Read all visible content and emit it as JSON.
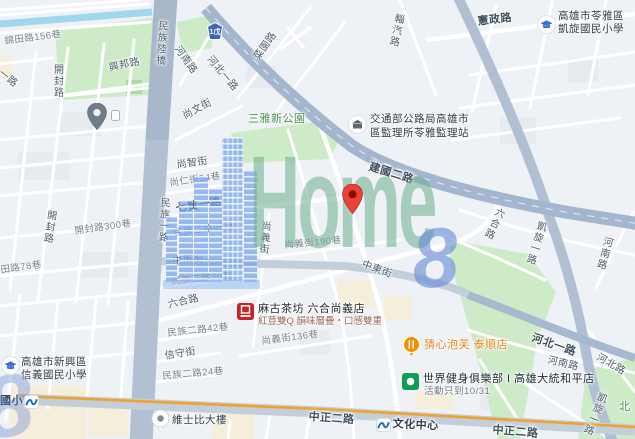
{
  "map": {
    "watermark": {
      "word": "Home",
      "digit": "8"
    },
    "colors": {
      "land": "#eef1f5",
      "park": "#cdebc7",
      "water": "#9fd8ec",
      "major_road": "#a3b6ce",
      "arterial_stripe": "#f0a32c",
      "watermark_green": "#71b193",
      "watermark_blue": "#658bd5",
      "destination_pin": "#ea4335"
    },
    "highway_shield": {
      "label": "1戊",
      "x": 207,
      "y": 22
    },
    "labels": [
      {
        "n": "road-label-jintian-156",
        "t": "錦田路156巷",
        "x": 4,
        "y": 37,
        "r": -7,
        "c": "lane"
      },
      {
        "n": "road-label-xingbang",
        "t": "興邦路",
        "x": 108,
        "y": 63,
        "r": -12,
        "c": "road"
      },
      {
        "n": "road-label-kaifeng-n",
        "t": "開封路",
        "x": 51,
        "y": 64,
        "r": 0,
        "c": "road",
        "v": true
      },
      {
        "n": "road-label-yilu",
        "t": "一路",
        "x": 3,
        "y": 68,
        "r": 38,
        "c": "road"
      },
      {
        "n": "road-label-minzu-viaduct",
        "t": "民族陸橋",
        "x": 156,
        "y": 20,
        "r": 4,
        "c": "road",
        "v": true
      },
      {
        "n": "road-label-henan-n",
        "t": "河南路",
        "x": 181,
        "y": 44,
        "r": 55,
        "c": "road"
      },
      {
        "n": "road-label-shangwen",
        "t": "尚文街",
        "x": 181,
        "y": 112,
        "r": -28,
        "c": "road"
      },
      {
        "n": "road-label-shangzhi",
        "t": "尚智街",
        "x": 176,
        "y": 160,
        "r": -8,
        "c": "road"
      },
      {
        "n": "road-label-shangren-54",
        "t": "尚仁街54巷",
        "x": 169,
        "y": 179,
        "r": -8,
        "c": "lane"
      },
      {
        "n": "road-label-qixian-1",
        "t": "七賢一路",
        "x": 175,
        "y": 203,
        "r": -9,
        "c": "roadb"
      },
      {
        "n": "road-label-minzu-1",
        "t": "民族一路",
        "x": 158,
        "y": 197,
        "r": 3,
        "c": "road",
        "v": true
      },
      {
        "n": "road-label-minzu2-95",
        "t": "民族二路95巷",
        "x": 173,
        "y": 229,
        "r": -7,
        "c": "lane"
      },
      {
        "n": "road-label-zhongdong-w",
        "t": "中東街",
        "x": 172,
        "y": 256,
        "r": -4,
        "c": "road"
      },
      {
        "n": "road-label-kaifeng-300",
        "t": "開封路300巷",
        "x": 74,
        "y": 227,
        "r": -8,
        "c": "lane"
      },
      {
        "n": "road-label-tian-78",
        "t": "田路78巷",
        "x": 0,
        "y": 266,
        "r": -8,
        "c": "lane"
      },
      {
        "n": "road-label-kaifeng-s",
        "t": "開封路",
        "x": 45,
        "y": 209,
        "r": 8,
        "c": "road",
        "v": true
      },
      {
        "n": "road-label-minzu2-70",
        "t": "民族二路70巷",
        "x": 171,
        "y": 277,
        "r": -5,
        "c": "lane"
      },
      {
        "n": "road-label-shangyi",
        "t": "尚義街",
        "x": 259,
        "y": 220,
        "r": 5,
        "c": "road",
        "v": true
      },
      {
        "n": "road-label-shangyi-190",
        "t": "尚義街190巷",
        "x": 284,
        "y": 241,
        "r": -5,
        "c": "lane"
      },
      {
        "n": "road-label-zhongdong-e",
        "t": "中東街",
        "x": 364,
        "y": 259,
        "r": 20,
        "c": "road"
      },
      {
        "n": "park-label-sanya",
        "t": "三雅新公園",
        "x": 248,
        "y": 113,
        "r": 0,
        "c": "park"
      },
      {
        "n": "road-label-hebei1-n",
        "t": "河北一路",
        "x": 213,
        "y": 54,
        "r": 50,
        "c": "road"
      },
      {
        "n": "road-label-caiyuan",
        "t": "菜園路",
        "x": 252,
        "y": 56,
        "r": -55,
        "c": "road"
      },
      {
        "n": "road-label-ziqi",
        "t": "輜汽路",
        "x": 393,
        "y": 12,
        "r": 12,
        "c": "road",
        "v": true
      },
      {
        "n": "road-label-xianzheng",
        "t": "憲政路",
        "x": 477,
        "y": 16,
        "r": -7,
        "c": "roadb"
      },
      {
        "n": "road-label-jianguo-2",
        "t": "建國二路",
        "x": 371,
        "y": 161,
        "r": 17,
        "c": "roadb"
      },
      {
        "n": "road-label-liuhe-n",
        "t": "六合路",
        "x": 495,
        "y": 205,
        "r": 25,
        "c": "road",
        "v": true
      },
      {
        "n": "road-label-kaixuan-mid",
        "t": "凱旋一路",
        "x": 536,
        "y": 219,
        "r": 17,
        "c": "road",
        "v": true
      },
      {
        "n": "road-label-henan-e",
        "t": "河南路",
        "x": 602,
        "y": 235,
        "r": 15,
        "c": "road",
        "v": true
      },
      {
        "n": "road-label-hebei1-s",
        "t": "河北一路",
        "x": 534,
        "y": 332,
        "r": 19,
        "c": "roadb"
      },
      {
        "n": "road-label-henan-s",
        "t": "河南路",
        "x": 549,
        "y": 355,
        "r": 13,
        "c": "road"
      },
      {
        "n": "road-label-hebei",
        "t": "河北路",
        "x": 600,
        "y": 352,
        "r": 30,
        "c": "road"
      },
      {
        "n": "road-label-liuhe-s",
        "t": "六合路",
        "x": 167,
        "y": 300,
        "r": -13,
        "c": "road"
      },
      {
        "n": "road-label-minzu2-42",
        "t": "民族二路42巷",
        "x": 167,
        "y": 329,
        "r": -6,
        "c": "lane"
      },
      {
        "n": "road-label-xinshou",
        "t": "信守街",
        "x": 164,
        "y": 351,
        "r": -9,
        "c": "road"
      },
      {
        "n": "road-label-minzu2-24",
        "t": "民族二路24巷",
        "x": 162,
        "y": 372,
        "r": -5,
        "c": "lane"
      },
      {
        "n": "road-label-shangyi-136",
        "t": "尚義街136巷",
        "x": 261,
        "y": 337,
        "r": -7,
        "c": "lane"
      },
      {
        "n": "road-label-zhongzheng-w",
        "t": "中正二路",
        "x": 309,
        "y": 411,
        "r": 4,
        "c": "roadb"
      },
      {
        "n": "road-label-zhongzheng-e",
        "t": "中正二路",
        "x": 493,
        "y": 424,
        "r": 5,
        "c": "roadb"
      },
      {
        "n": "road-label-kaixuan-s",
        "t": "凱旋一路",
        "x": 597,
        "y": 390,
        "r": 22,
        "c": "road",
        "v": true
      },
      {
        "n": "park-label-north",
        "t": "北",
        "x": 619,
        "y": 401,
        "r": 0,
        "c": "park"
      },
      {
        "n": "station-label-guoxiao",
        "t": "國小",
        "x": 0,
        "y": 395,
        "r": 0,
        "c": "station"
      },
      {
        "n": "station-label-cultural-center",
        "t": "文化中心",
        "x": 393,
        "y": 418,
        "r": 3,
        "c": "station"
      },
      {
        "n": "poi-label-weishibi",
        "t": "維士比大樓",
        "x": 172,
        "y": 414,
        "r": 0,
        "c": "poi"
      },
      {
        "n": "poi-label-kaixuan-school-1",
        "t": "高雄市苓雅區",
        "x": 558,
        "y": 10,
        "r": 0,
        "c": "poi"
      },
      {
        "n": "poi-label-kaixuan-school-2",
        "t": "凱旋國民小學",
        "x": 558,
        "y": 23,
        "r": 0,
        "c": "poi"
      },
      {
        "n": "poi-label-dmv-1",
        "t": "交通部公路局高雄市",
        "x": 370,
        "y": 113,
        "r": 0,
        "c": "poi"
      },
      {
        "n": "poi-label-dmv-2",
        "t": "區監理所苓雅監理站",
        "x": 370,
        "y": 127,
        "r": 0,
        "c": "poi"
      },
      {
        "n": "poi-label-xinyi-school-1",
        "t": "高雄市新興區",
        "x": 21,
        "y": 356,
        "r": 0,
        "c": "poi"
      },
      {
        "n": "poi-label-xinyi-school-2",
        "t": "信義國民小學",
        "x": 21,
        "y": 369,
        "r": 0,
        "c": "poi"
      },
      {
        "n": "poi-label-macu",
        "t": "麻古茶坊 六合尚義店",
        "x": 258,
        "y": 303,
        "r": 0,
        "c": "ptitle"
      },
      {
        "n": "poi-ad-macu",
        "t": "紅荳雙Q 韻味層疊・口感雙重",
        "x": 258,
        "y": 317,
        "r": 0,
        "c": "ad"
      },
      {
        "n": "poi-label-puff",
        "t": "猜心泡芙 泰順店",
        "x": 424,
        "y": 339,
        "r": 0,
        "c": "orange"
      },
      {
        "n": "poi-label-worldgym",
        "t": "世界健身俱樂部 I 高雄大統和平店",
        "x": 423,
        "y": 373,
        "r": 0,
        "c": "ptitle"
      },
      {
        "n": "poi-sub-worldgym",
        "t": "活動只到10/31",
        "x": 424,
        "y": 387,
        "r": 0,
        "c": "sub"
      }
    ],
    "pins": [
      {
        "n": "generic-gray-pin",
        "k": "gray",
        "x": 87,
        "y": 103
      },
      {
        "n": "small-poi-box",
        "k": "minibox",
        "x": 111,
        "y": 110
      },
      {
        "n": "dmv-office-icon",
        "k": "dmv",
        "x": 348,
        "y": 115
      },
      {
        "n": "kaixuan-school-icon",
        "k": "school",
        "x": 537,
        "y": 15
      },
      {
        "n": "xinyi-school-icon",
        "k": "school",
        "x": 1,
        "y": 356
      },
      {
        "n": "destination-red-pin",
        "k": "red",
        "x": 342,
        "y": 184
      },
      {
        "n": "macu-teashop-icon",
        "k": "macu",
        "x": 237,
        "y": 303
      },
      {
        "n": "restaurant-pin",
        "k": "food",
        "x": 403,
        "y": 336
      },
      {
        "n": "worldgym-icon",
        "k": "gym",
        "x": 402,
        "y": 373
      },
      {
        "n": "weishibi-building-pin",
        "k": "bldg",
        "x": 151,
        "y": 409
      },
      {
        "n": "mrt-station-icon-guoxiao",
        "k": "mrt",
        "x": 24,
        "y": 395
      },
      {
        "n": "mrt-station-icon-cultural",
        "k": "mrt",
        "x": 376,
        "y": 418
      }
    ]
  }
}
